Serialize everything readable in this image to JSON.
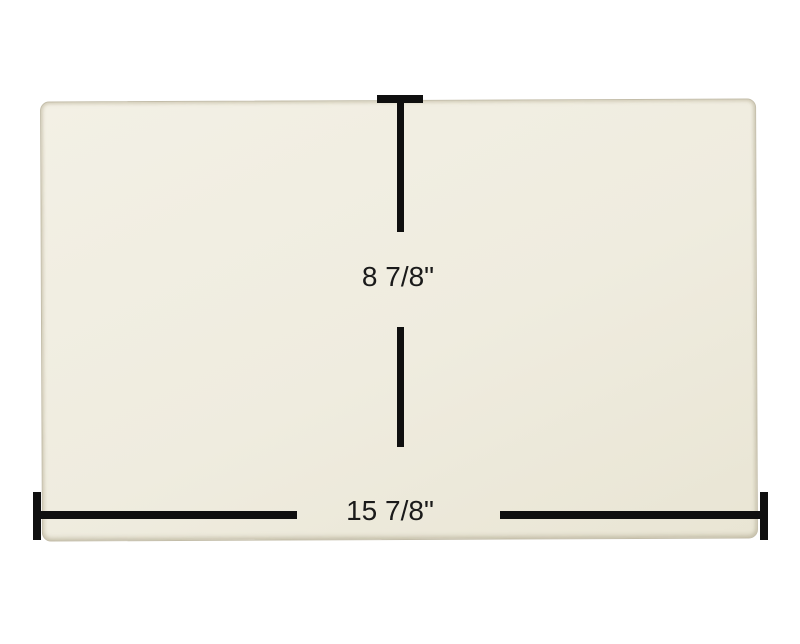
{
  "diagram": {
    "subject": "rectangular cream glass panel with dimension callouts"
  },
  "dimensions": {
    "height_label": "8 7/8\"",
    "width_label": "15 7/8\""
  },
  "colors": {
    "background": "#ffffff",
    "panel_top": "#f3f0e5",
    "panel_bottom": "#e9e5d4",
    "panel_edge": "#c3bda9",
    "line": "#0f0f0f",
    "text": "#1a1a1a"
  }
}
